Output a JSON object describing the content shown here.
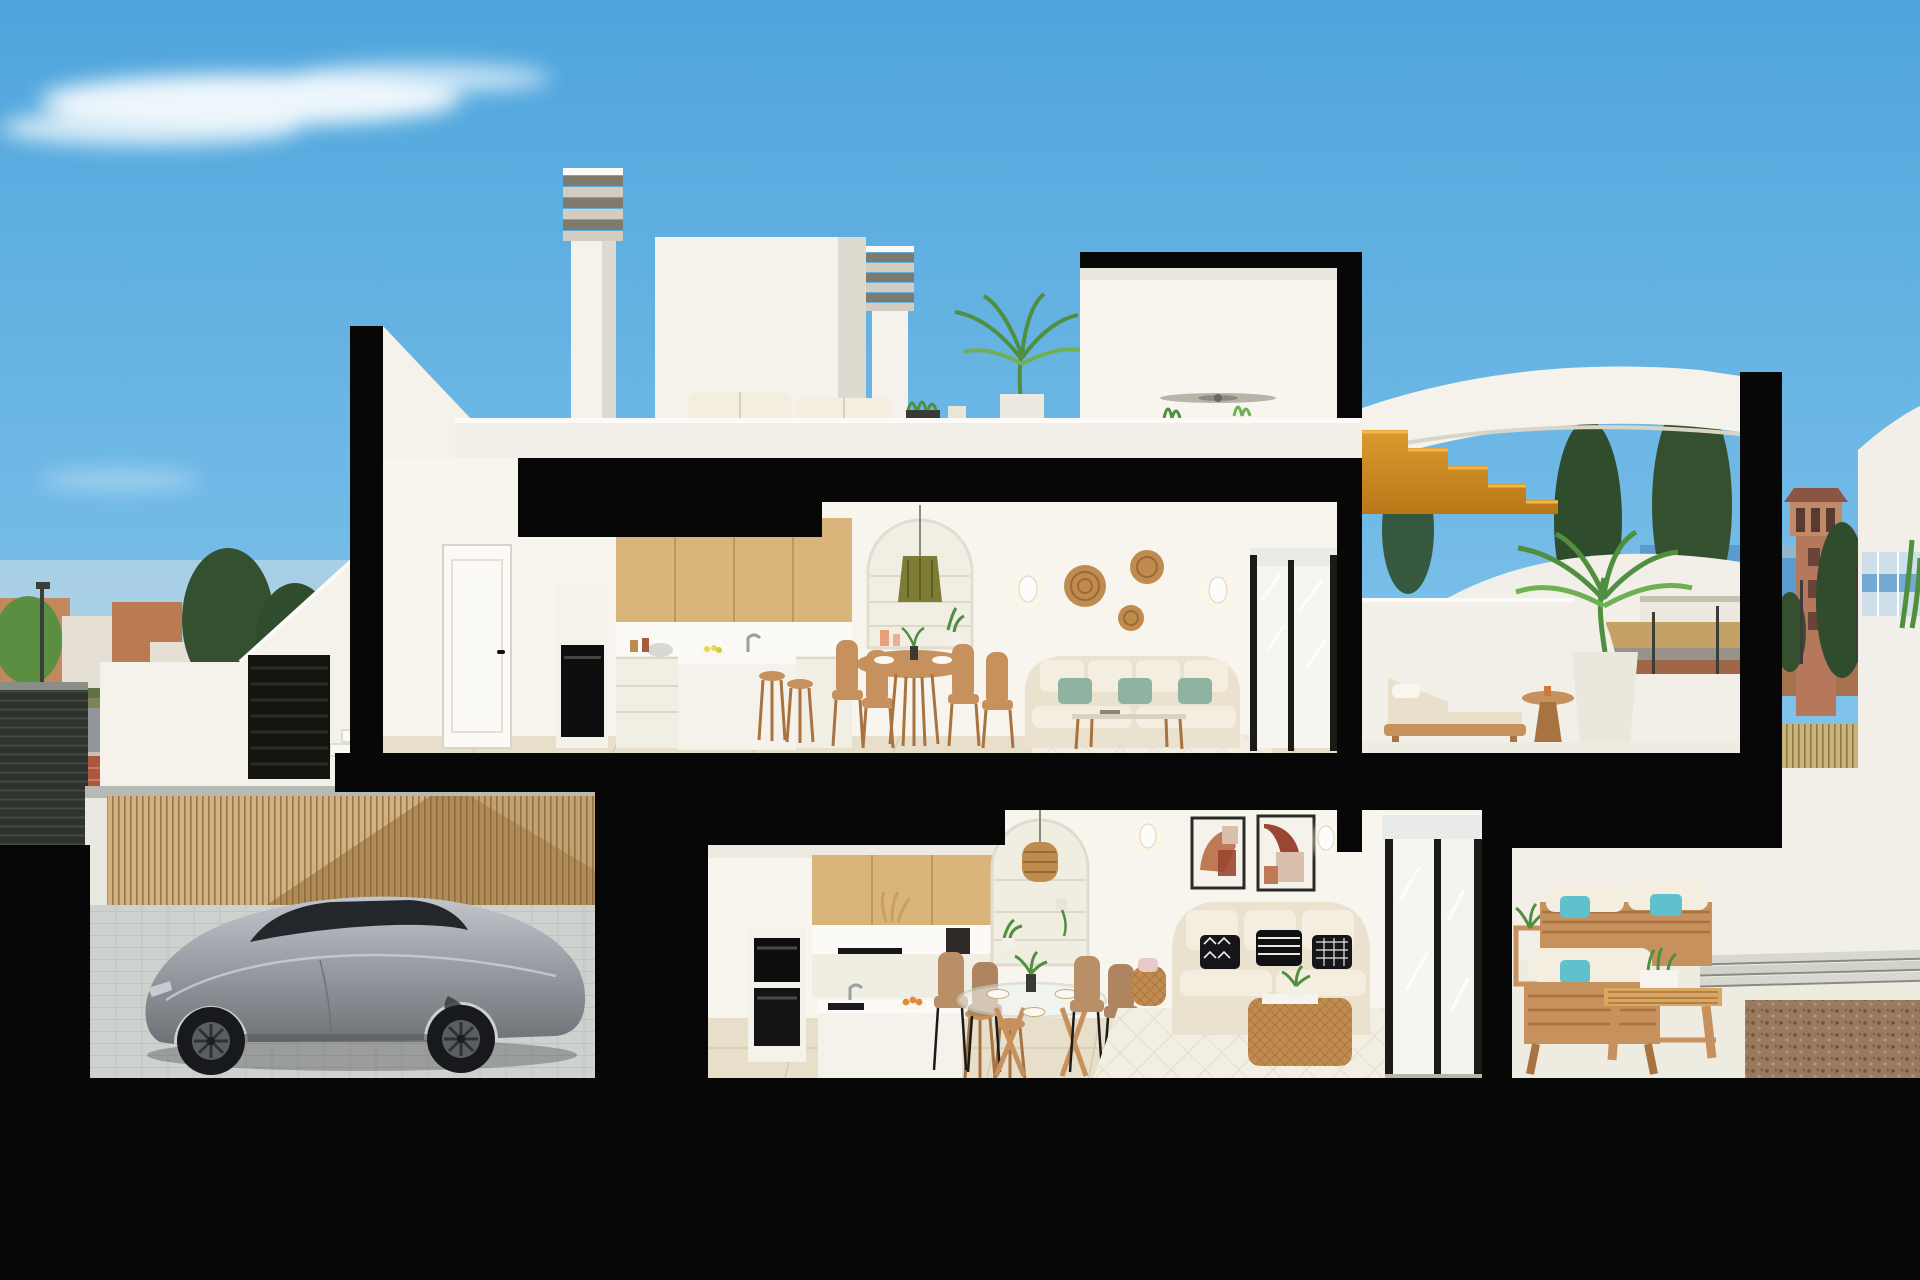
{
  "title": "Cutaway cross-section render of a two-storey coastal duplex",
  "palette": {
    "skyTop": "#4FA5DC",
    "skyMid": "#7EC2EA",
    "skyHorizon": "#BADDF2",
    "cloud": "#F4FAFD",
    "cut": "#070707",
    "wallWhite": "#F4F2EB",
    "wallBright": "#FBFAF6",
    "wallShade": "#DDDACF",
    "wallWarm": "#F8F5EE",
    "parapet": "#F1EFE7",
    "wood": "#D9B57C",
    "woodMid": "#C6915C",
    "woodDark": "#A87340",
    "oakStair": "#DC9A2E",
    "oakStairDark": "#B87818",
    "floorTile": "#E7DFCA",
    "tileSeam": "#D6CBB2",
    "floorLight": "#EEEBE0",
    "bamboo": "#B18A55",
    "bambooLight": "#D8B888",
    "bambooLine": "#7D6238",
    "paver": "#CED2CF",
    "paverLine": "#BCC0BD",
    "carBody": "#9B9EA4",
    "carBodyDark": "#6E7176",
    "carGlass": "#23272B",
    "carWheel": "#17191C",
    "carRim": "#5A5E63",
    "sofaBeige": "#EAE2CF",
    "cushionCream": "#F3EEDF",
    "cushionSage": "#8FB3A0",
    "cushionTeal": "#5EC1CC",
    "rattan": "#C08B4F",
    "rattanDark": "#9A6A35",
    "oliveLamp": "#7C7C35",
    "artTerracotta": "#BF7A55",
    "artRust": "#9A4632",
    "artBlush": "#D8C0AC",
    "pillowBlack": "#16161A",
    "frameDark": "#1C1A16",
    "glassPane": "#F5F6F2",
    "glassBlind": "#E9EBE8",
    "seaBlue": "#5A9BD0",
    "mountain": "#8FA8BD",
    "skylineFar": "#9AB4C8",
    "treeDark": "#2F4C2C",
    "treeMid": "#35502E",
    "treeGreen": "#4F8F3F",
    "treeLight": "#6FB054",
    "field": "#C4A265",
    "dirt": "#A06648",
    "roadAsphalt": "#92969A",
    "sidewalkRed": "#AD5640",
    "sidewalkStripe": "#C77A5E",
    "towerTerra": "#B5785C",
    "towerRoof": "#8A5542",
    "hedge": "#C9B47A",
    "hedgeLine": "#8F7A45",
    "gravel": "#9A7A5E",
    "gravelDark": "#6E5240",
    "gravelLight": "#B5967A",
    "gateDark": "#2F332E",
    "gateSlat": "#454A42",
    "signBlue": "#2468C4",
    "poleDark": "#3C3C38",
    "concreteCap": "#B6BAB4",
    "glow": "#FFF8E0",
    "orangeFruit": "#E08A3A",
    "rugBase": "#F2EEE2",
    "rugLine": "#D8D2C2",
    "townTerra": "#C08A5E",
    "townTerra2": "#BA7B52",
    "townWhite": "#E6E0D4",
    "shedRoof": "#55606A",
    "grass": "#7D8456"
  },
  "scene": {
    "setting": "daytime coastal town, blue sky with wispy clouds",
    "building": "black-edged cutaway of a two-storey duplex with roof terrace, garage and street frontage",
    "roof_level": [
      "louvered chimney",
      "white penthouse volume",
      "second louvered chimney",
      "outdoor sofa with white cushions",
      "potted palm",
      "planter boxes",
      "white parapet",
      "penthouse room with ceiling fan"
    ],
    "upper_floor": [
      "white interior door",
      "built-in oven column",
      "oak wall cabinets",
      "white kitchen island with stools",
      "round wooden dining table with four chairs",
      "arched shelf niche with green pendant lamp",
      "two wall sconces",
      "three rattan wall baskets",
      "white sofa with sage cushions",
      "glass coffee table",
      "area rug",
      "sliding glass door"
    ],
    "upper_terrace": [
      "wooden sun lounger with beige cushion",
      "round wooden side table",
      "potted palm",
      "curved white parapet",
      "street view behind parapet"
    ],
    "ground_floor": [
      "built-in double oven",
      "oak upper cabinets",
      "coffee machine",
      "white peninsula with black sink and fruit bowl",
      "two wooden stools",
      "arched shelf niche with rattan pendant",
      "round glass dining table with four tan chairs",
      "two abstract art prints",
      "two wall sconces",
      "beige sofa with black-and-white patterned cushions",
      "rattan basket coffee table",
      "diamond-pattern rug",
      "sliding glass doors"
    ],
    "lower_terrace": [
      "wooden outdoor sofa set with white cushions and teal pillows",
      "slatted wooden coffee table with planter",
      "plant side table",
      "strip paving",
      "gravel bed"
    ],
    "garage": [
      "silver sports coupe",
      "bamboo slat wall with diagonal light",
      "concrete cap",
      "paver floor",
      "white pier"
    ],
    "street_left": [
      "town skyline",
      "conifer trees",
      "asphalt road",
      "red brick sidewalk",
      "zebra crossing",
      "pedestrian sign",
      "street lamp",
      "dark slatted gate",
      "white exterior staircase with louvered door"
    ],
    "street_right": [
      "terracotta watchtower",
      "sea horizon",
      "mountains",
      "conifer trees",
      "dry field",
      "bamboo hedge",
      "street lamps",
      "golden wooden staircase",
      "curved white roof band",
      "neighbour volume with glass balustrade"
    ]
  }
}
